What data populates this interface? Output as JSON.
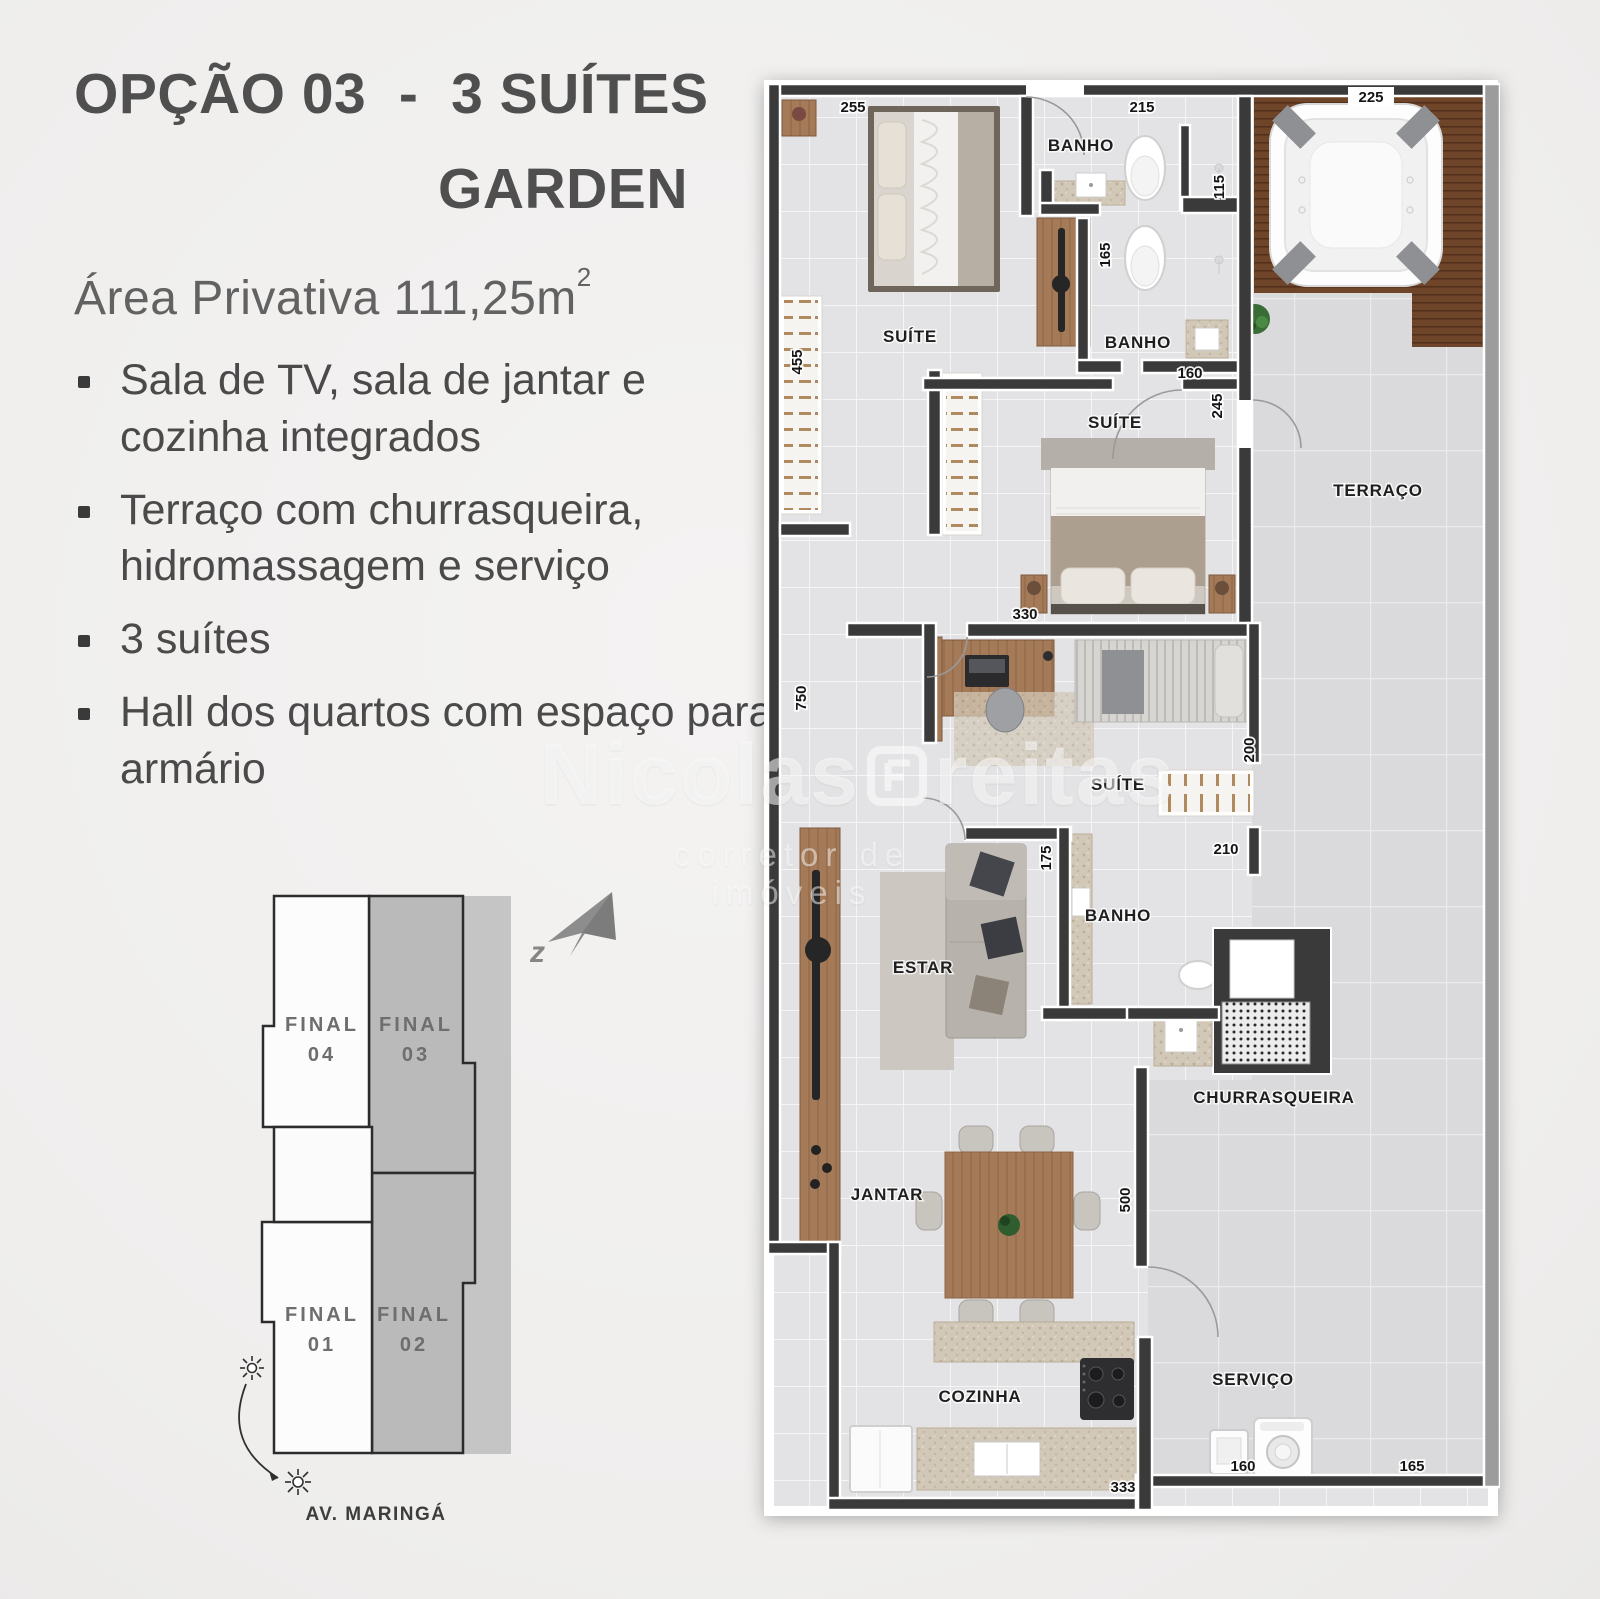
{
  "header": {
    "title_line1": "OPÇÃO 03  -  3 SUÍTES",
    "title_line2": "GARDEN",
    "area_text": "Área Privativa 111,25m",
    "area_sup": "2"
  },
  "features": [
    {
      "text": "Sala de TV, sala de jantar e cozinha integrados"
    },
    {
      "text": "Terraço com churrasqueira, hidromassagem e serviço"
    },
    {
      "text": "3 suítes"
    },
    {
      "text": "Hall dos quartos com espaço para armário"
    }
  ],
  "unit_map": {
    "units": [
      {
        "line1": "FINAL",
        "line2": "04"
      },
      {
        "line1": "FINAL",
        "line2": "03"
      },
      {
        "line1": "FINAL",
        "line2": "01"
      },
      {
        "line1": "FINAL",
        "line2": "02"
      }
    ],
    "street_label": "AV. MARINGÁ",
    "compass_letter": "z"
  },
  "watermark": {
    "name_part1": "Nicolas",
    "name_part2": "reitas",
    "tagline": "corretor de imóveis"
  },
  "floorplan": {
    "labels": {
      "suite": "SUÍTE",
      "banho": "BANHO",
      "terraco": "TERRAÇO",
      "estar": "ESTAR",
      "jantar": "JANTAR",
      "cozinha": "COZINHA",
      "servico": "SERVIÇO",
      "churrasqueira": "CHURRASQUEIRA"
    },
    "dims": {
      "d255": "255",
      "d215": "215",
      "d225": "225",
      "d115": "115",
      "d165": "165",
      "d455": "455",
      "d160": "160",
      "d245": "245",
      "d330": "330",
      "d750": "750",
      "d200": "200",
      "d210": "210",
      "d175": "175",
      "d500": "500",
      "d333": "333",
      "d160b": "160",
      "d165b": "165"
    },
    "colors": {
      "wall": "#3a3a3a",
      "terrace_wall": "#9c9c9c",
      "wood": "#a57a58",
      "deck": "#6f4529",
      "floor": "#e3e3e5",
      "terrace_floor": "#dadadc",
      "unit_gray": "#bababa"
    }
  }
}
